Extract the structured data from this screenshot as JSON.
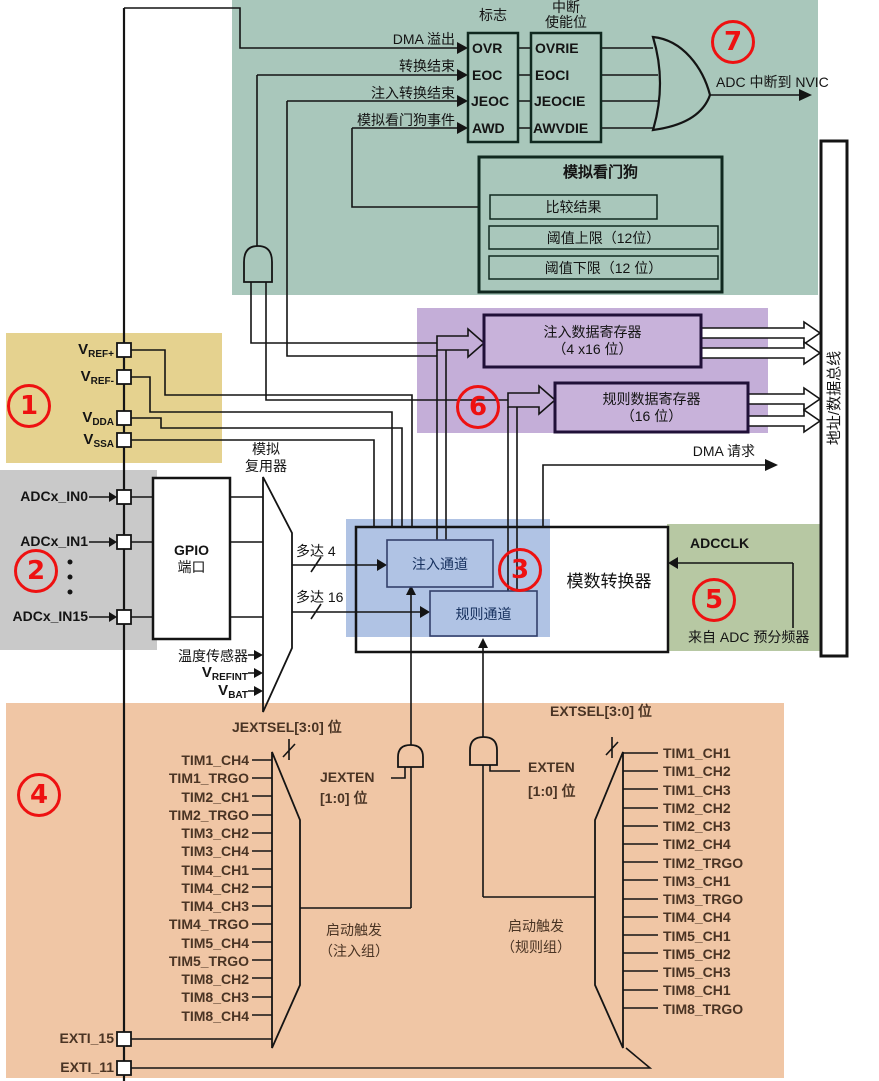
{
  "colors": {
    "teal": "#a9c7bb",
    "yellow": "#e5d28f",
    "gray": "#c9c9c9",
    "purple": "#c4aed8",
    "regbox": "#c8b2da",
    "blue": "#b0c3e4",
    "green": "#b7c8a3",
    "orange": "#f0c6a5",
    "red": "#ee1111",
    "ink": "#141414",
    "navy": "#16305e",
    "brown": "#4a3424",
    "wire": "#141414"
  },
  "badges": {
    "b1": "1",
    "b2": "2",
    "b3": "3",
    "b4": "4",
    "b5": "5",
    "b6": "6",
    "b7": "7"
  },
  "interrupt": {
    "flag_header": "标志",
    "enable_header_line1": "中断",
    "enable_header_line2": "使能位",
    "inputs": [
      "DMA 溢出",
      "转换结束",
      "注入转换结束",
      "模拟看门狗事件"
    ],
    "flags": [
      "OVR",
      "EOC",
      "JEOC",
      "AWD"
    ],
    "enables": [
      "OVRIE",
      "EOCI",
      "JEOCIE",
      "AWVDIE"
    ],
    "output_label": "ADC 中断到 NVIC"
  },
  "watchdog": {
    "title": "模拟看门狗",
    "compare": "比较结果",
    "upper": "阈值上限（12位）",
    "lower": "阈值下限（12 位）"
  },
  "registers": {
    "injected_line1": "注入数据寄存器",
    "injected_line2": "（4 x16 位）",
    "regular_line1": "规则数据寄存器",
    "regular_line2": "（16 位）"
  },
  "bus": {
    "label": "地址/数据总线"
  },
  "dma": {
    "label": "DMA 请求"
  },
  "supply": {
    "pins": [
      {
        "main": "V",
        "sub": "REF+"
      },
      {
        "main": "V",
        "sub": "REF-"
      },
      {
        "main": "V",
        "sub": "DDA"
      },
      {
        "main": "V",
        "sub": "SSA"
      }
    ]
  },
  "analog_inputs": {
    "in0": "ADCx_IN0",
    "in1": "ADCx_IN1",
    "in15": "ADCx_IN15",
    "gpio_line1": "GPIO",
    "gpio_line2": "端口"
  },
  "mux": {
    "label_line1": "模拟",
    "label_line2": "复用器",
    "up_to_4": "多达 4",
    "up_to_16": "多达 16"
  },
  "internal": {
    "temp": "温度传感器",
    "vrefint": {
      "main": "V",
      "sub": "REFINT"
    },
    "vbat": {
      "main": "V",
      "sub": "BAT"
    }
  },
  "converter": {
    "injected": "注入通道",
    "regular": "规则通道",
    "adc": "模数转换器",
    "adcclk": "ADCCLK",
    "prescaler": "来自 ADC 预分频器"
  },
  "triggers": {
    "jextsel": "JEXTSEL[3:0] 位",
    "extsel": "EXTSEL[3:0] 位",
    "jexten_line1": "JEXTEN",
    "jexten_line2": "[1:0] 位",
    "exten_line1": "EXTEN",
    "exten_line2": "[1:0] 位",
    "injected_trigger_line1": "启动触发",
    "injected_trigger_line2": "（注入组）",
    "regular_trigger_line1": "启动触发",
    "regular_trigger_line2": "（规则组）",
    "left_sources": [
      "TIM1_CH4",
      "TIM1_TRGO",
      "TIM2_CH1",
      "TIM2_TRGO",
      "TIM3_CH2",
      "TIM3_CH4",
      "TIM4_CH1",
      "TIM4_CH2",
      "TIM4_CH3",
      "TIM4_TRGO",
      "TIM5_CH4",
      "TIM5_TRGO",
      "TIM8_CH2",
      "TIM8_CH3",
      "TIM8_CH4"
    ],
    "right_sources": [
      "TIM1_CH1",
      "TIM1_CH2",
      "TIM1_CH3",
      "TIM2_CH2",
      "TIM2_CH3",
      "TIM2_CH4",
      "TIM2_TRGO",
      "TIM3_CH1",
      "TIM3_TRGO",
      "TIM4_CH4",
      "TIM5_CH1",
      "TIM5_CH2",
      "TIM5_CH3",
      "TIM8_CH1",
      "TIM8_TRGO"
    ],
    "exti15": "EXTI_15",
    "exti11": "EXTI_11"
  }
}
